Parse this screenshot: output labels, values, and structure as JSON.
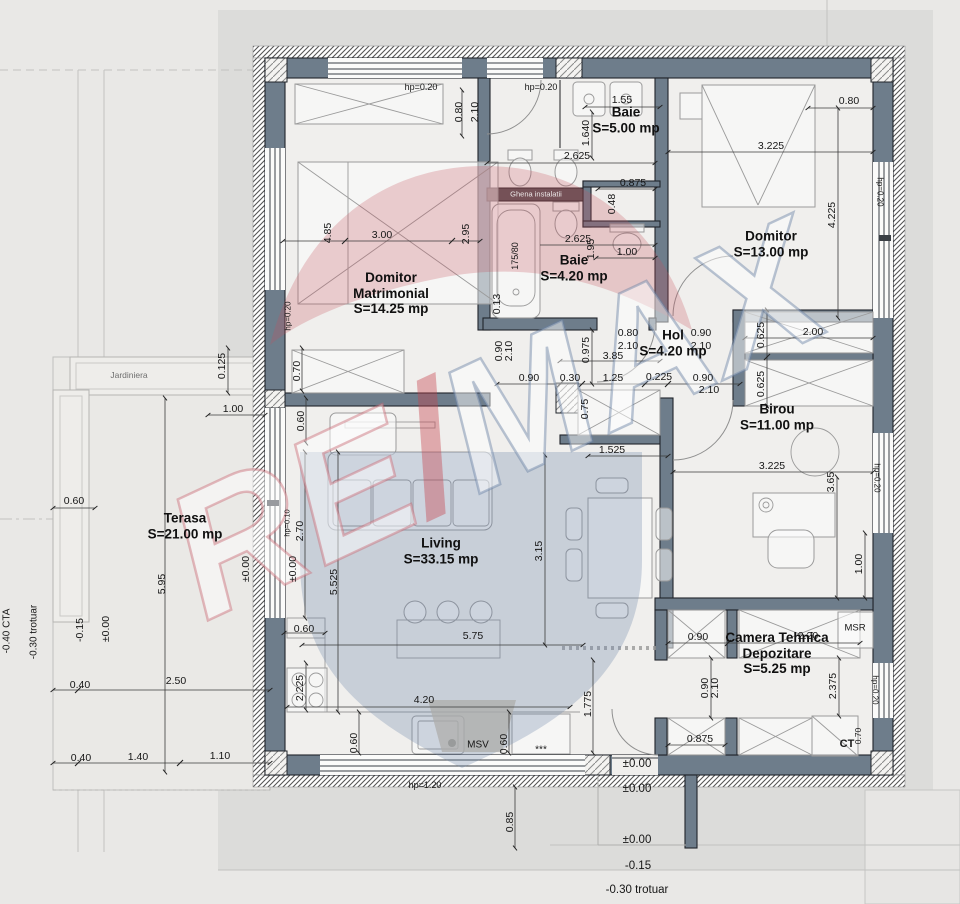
{
  "watermark": {
    "re": "RE",
    "slash": "/",
    "max": "MAX"
  },
  "rooms": [
    {
      "lines": [
        "Baie",
        "S=5.00 mp"
      ],
      "x": 626,
      "y": 120
    },
    {
      "lines": [
        "Domitor",
        "S=13.00 mp"
      ],
      "x": 771,
      "y": 244
    },
    {
      "lines": [
        "Baie",
        "S=4.20 mp"
      ],
      "x": 574,
      "y": 268
    },
    {
      "lines": [
        "Domitor",
        "Matrimonial",
        "S=14.25 mp"
      ],
      "x": 391,
      "y": 293
    },
    {
      "lines": [
        "Hol",
        "S=4.20 mp"
      ],
      "x": 673,
      "y": 343
    },
    {
      "lines": [
        "Birou",
        "S=11.00 mp"
      ],
      "x": 777,
      "y": 417
    },
    {
      "lines": [
        "Terasa",
        "S=21.00 mp"
      ],
      "x": 185,
      "y": 526
    },
    {
      "lines": [
        "Living",
        "S=33.15 mp"
      ],
      "x": 441,
      "y": 551
    },
    {
      "lines": [
        "Camera Tehnica",
        "Depozitare",
        "S=5.25 mp"
      ],
      "x": 777,
      "y": 653
    }
  ],
  "dims": [
    {
      "t": "hp=0.20",
      "x": 421,
      "y": 87,
      "s": 9
    },
    {
      "t": "hp=0.20",
      "x": 541,
      "y": 87,
      "s": 9
    },
    {
      "t": "0.80",
      "x": 459,
      "y": 112,
      "r": -90
    },
    {
      "t": "2.10",
      "x": 475,
      "y": 112,
      "r": -90
    },
    {
      "t": "1.55",
      "x": 622,
      "y": 100
    },
    {
      "t": "1.640",
      "x": 586,
      "y": 133,
      "r": -90
    },
    {
      "t": "2.625",
      "x": 577,
      "y": 156
    },
    {
      "t": "0.875",
      "x": 633,
      "y": 183
    },
    {
      "t": "0.48",
      "x": 612,
      "y": 204,
      "r": -90
    },
    {
      "t": "1.00",
      "x": 627,
      "y": 252
    },
    {
      "t": "0.80",
      "x": 849,
      "y": 101
    },
    {
      "t": "3.225",
      "x": 771,
      "y": 146
    },
    {
      "t": "4.225",
      "x": 832,
      "y": 215,
      "r": -90
    },
    {
      "t": "hp=0.20",
      "x": 880,
      "y": 192,
      "r": 90,
      "s": 8
    },
    {
      "t": "4.85",
      "x": 328,
      "y": 233,
      "r": -90
    },
    {
      "t": "3.00",
      "x": 382,
      "y": 235
    },
    {
      "t": "2.95",
      "x": 466,
      "y": 234,
      "r": -90
    },
    {
      "t": "175/80",
      "x": 515,
      "y": 256,
      "r": -90,
      "s": 9
    },
    {
      "t": "2.625",
      "x": 578,
      "y": 239
    },
    {
      "t": "1.95",
      "x": 591,
      "y": 249,
      "r": -90
    },
    {
      "t": "Ghena instalatii",
      "x": 536,
      "y": 194,
      "s": 7.5,
      "c": "wm"
    },
    {
      "t": "0.13",
      "x": 497,
      "y": 304,
      "r": -90
    },
    {
      "t": "hp=0.20",
      "x": 288,
      "y": 316,
      "r": -90,
      "s": 8
    },
    {
      "t": "0.80",
      "x": 628,
      "y": 333
    },
    {
      "t": "2.10",
      "x": 628,
      "y": 346
    },
    {
      "t": "0.90",
      "x": 701,
      "y": 333
    },
    {
      "t": "2.10",
      "x": 701,
      "y": 346
    },
    {
      "t": "0.90",
      "x": 499,
      "y": 351,
      "r": -90
    },
    {
      "t": "2.10",
      "x": 509,
      "y": 351,
      "r": -90
    },
    {
      "t": "0.975",
      "x": 586,
      "y": 350,
      "r": -90
    },
    {
      "t": "3.85",
      "x": 613,
      "y": 356
    },
    {
      "t": "0.90",
      "x": 529,
      "y": 378
    },
    {
      "t": "0.30",
      "x": 570,
      "y": 378
    },
    {
      "t": "1.25",
      "x": 613,
      "y": 378
    },
    {
      "t": "0.225",
      "x": 659,
      "y": 377
    },
    {
      "t": "0.90",
      "x": 703,
      "y": 378
    },
    {
      "t": "2.10",
      "x": 709,
      "y": 390
    },
    {
      "t": "0.625",
      "x": 761,
      "y": 335,
      "r": -90
    },
    {
      "t": "2.00",
      "x": 813,
      "y": 332
    },
    {
      "t": "0.625",
      "x": 761,
      "y": 384,
      "r": -90
    },
    {
      "t": "0.125",
      "x": 222,
      "y": 366,
      "r": -90
    },
    {
      "t": "Jardiniera",
      "x": 129,
      "y": 375,
      "s": 8.5,
      "c": "lt"
    },
    {
      "t": "1.00",
      "x": 233,
      "y": 409
    },
    {
      "t": "0.70",
      "x": 297,
      "y": 371,
      "r": -90
    },
    {
      "t": "0.60",
      "x": 301,
      "y": 421,
      "r": -90
    },
    {
      "t": "0.75",
      "x": 585,
      "y": 409,
      "r": -90
    },
    {
      "t": "1.525",
      "x": 612,
      "y": 450
    },
    {
      "t": "3.225",
      "x": 772,
      "y": 466
    },
    {
      "t": "3.65",
      "x": 831,
      "y": 482,
      "r": -90
    },
    {
      "t": "hp=0.20",
      "x": 877,
      "y": 478,
      "r": 90,
      "s": 8
    },
    {
      "t": "1.00",
      "x": 859,
      "y": 564,
      "r": -90
    },
    {
      "t": "hp=0.10",
      "x": 287,
      "y": 523,
      "r": -90,
      "s": 7.5
    },
    {
      "t": "2.70",
      "x": 300,
      "y": 531,
      "r": -90
    },
    {
      "t": "±0.00",
      "x": 246,
      "y": 569,
      "r": -90
    },
    {
      "t": "±0.00",
      "x": 293,
      "y": 569,
      "r": -90
    },
    {
      "t": "5.525",
      "x": 334,
      "y": 582,
      "r": -90
    },
    {
      "t": "5.95",
      "x": 162,
      "y": 584,
      "r": -90
    },
    {
      "t": "0.60",
      "x": 74,
      "y": 501
    },
    {
      "t": "3.15",
      "x": 539,
      "y": 551,
      "r": -90
    },
    {
      "t": "5.75",
      "x": 473,
      "y": 636
    },
    {
      "t": "0.60",
      "x": 304,
      "y": 629
    },
    {
      "t": "-0.15",
      "x": 80,
      "y": 630,
      "r": -90
    },
    {
      "t": "±0.00",
      "x": 106,
      "y": 629,
      "r": -90
    },
    {
      "t": "-0.40 CTA",
      "x": 7,
      "y": 631,
      "r": -90,
      "s": 10
    },
    {
      "t": "-0.30 trotuar",
      "x": 34,
      "y": 632,
      "r": -90,
      "s": 10
    },
    {
      "t": "0.40",
      "x": 80,
      "y": 685
    },
    {
      "t": "2.50",
      "x": 176,
      "y": 681
    },
    {
      "t": "0.40",
      "x": 81,
      "y": 758
    },
    {
      "t": "1.40",
      "x": 138,
      "y": 757
    },
    {
      "t": "1.10",
      "x": 220,
      "y": 756
    },
    {
      "t": "2.225",
      "x": 300,
      "y": 688,
      "r": -90
    },
    {
      "t": "4.20",
      "x": 424,
      "y": 700
    },
    {
      "t": "0.60",
      "x": 354,
      "y": 743,
      "r": -90
    },
    {
      "t": "MSV",
      "x": 478,
      "y": 745,
      "s": 10
    },
    {
      "t": "0.60",
      "x": 504,
      "y": 744,
      "r": -90
    },
    {
      "t": "***",
      "x": 541,
      "y": 750,
      "s": 10
    },
    {
      "t": "1.775",
      "x": 588,
      "y": 704,
      "r": -90
    },
    {
      "t": "hp=1.20",
      "x": 425,
      "y": 785,
      "s": 9
    },
    {
      "t": "0.90",
      "x": 698,
      "y": 637
    },
    {
      "t": "2.20",
      "x": 808,
      "y": 636
    },
    {
      "t": "MSR",
      "x": 855,
      "y": 628,
      "s": 9.5
    },
    {
      "t": "0.90",
      "x": 705,
      "y": 688,
      "r": -90
    },
    {
      "t": "2.10",
      "x": 715,
      "y": 688,
      "r": -90
    },
    {
      "t": "2.375",
      "x": 833,
      "y": 686,
      "r": -90
    },
    {
      "t": "hp=0.20",
      "x": 875,
      "y": 690,
      "r": 90,
      "s": 8
    },
    {
      "t": "0.875",
      "x": 700,
      "y": 739
    },
    {
      "t": "CT",
      "x": 847,
      "y": 744,
      "s": 11,
      "b": 1
    },
    {
      "t": "0.70",
      "x": 858,
      "y": 736,
      "r": -90,
      "s": 8.5
    },
    {
      "t": "±0.00",
      "x": 637,
      "y": 764,
      "s": 11.5
    },
    {
      "t": "±0.00",
      "x": 637,
      "y": 789,
      "s": 11.5
    },
    {
      "t": "0.85",
      "x": 510,
      "y": 822,
      "r": -90
    },
    {
      "t": "±0.00",
      "x": 637,
      "y": 840,
      "s": 11.5
    },
    {
      "t": "-0.15",
      "x": 638,
      "y": 866,
      "s": 11.5
    },
    {
      "t": "-0.30 trotuar",
      "x": 637,
      "y": 890,
      "s": 11.5
    }
  ]
}
